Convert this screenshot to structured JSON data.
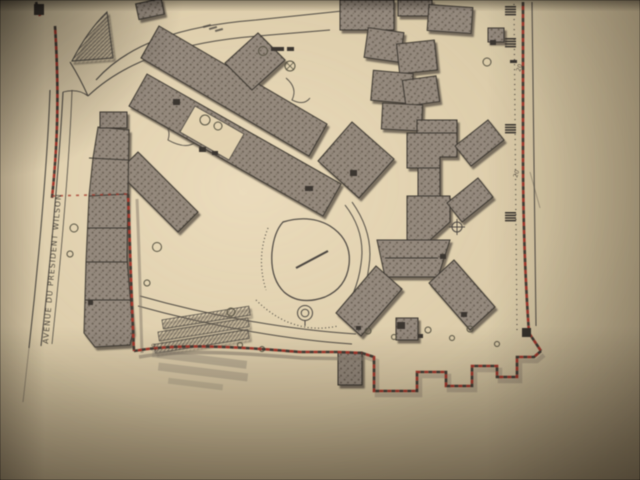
{
  "photo": {
    "subject": "Photograph of a printed site plan lying on paper, lit unevenly",
    "paper_color": "#e6d5b0",
    "shadow_color": "#a3957c"
  },
  "plan": {
    "street_label": "AVENUE DU PRESIDENT WILSON",
    "dimension_markers": [
      {
        "label": "20"
      },
      {
        "label": "20"
      },
      {
        "label": "20"
      }
    ],
    "boundary": {
      "style": "red dashed with alternating dark ticks",
      "color": "#ad3427"
    },
    "colors": {
      "paper": "#e6d5b0",
      "building_fill": "#95897b",
      "building_speckle": "#6c6153",
      "ink": "#4e4840",
      "red_dash": "#ad3427"
    },
    "features": [
      "curved access road (top left)",
      "hatched triangle traffic island",
      "diagonal building bands",
      "central oval lawn",
      "fan of three building wings (bottom centre)",
      "stepped site boundary (bottom right)",
      "diagonal ramp hatching (bottom left)"
    ]
  }
}
